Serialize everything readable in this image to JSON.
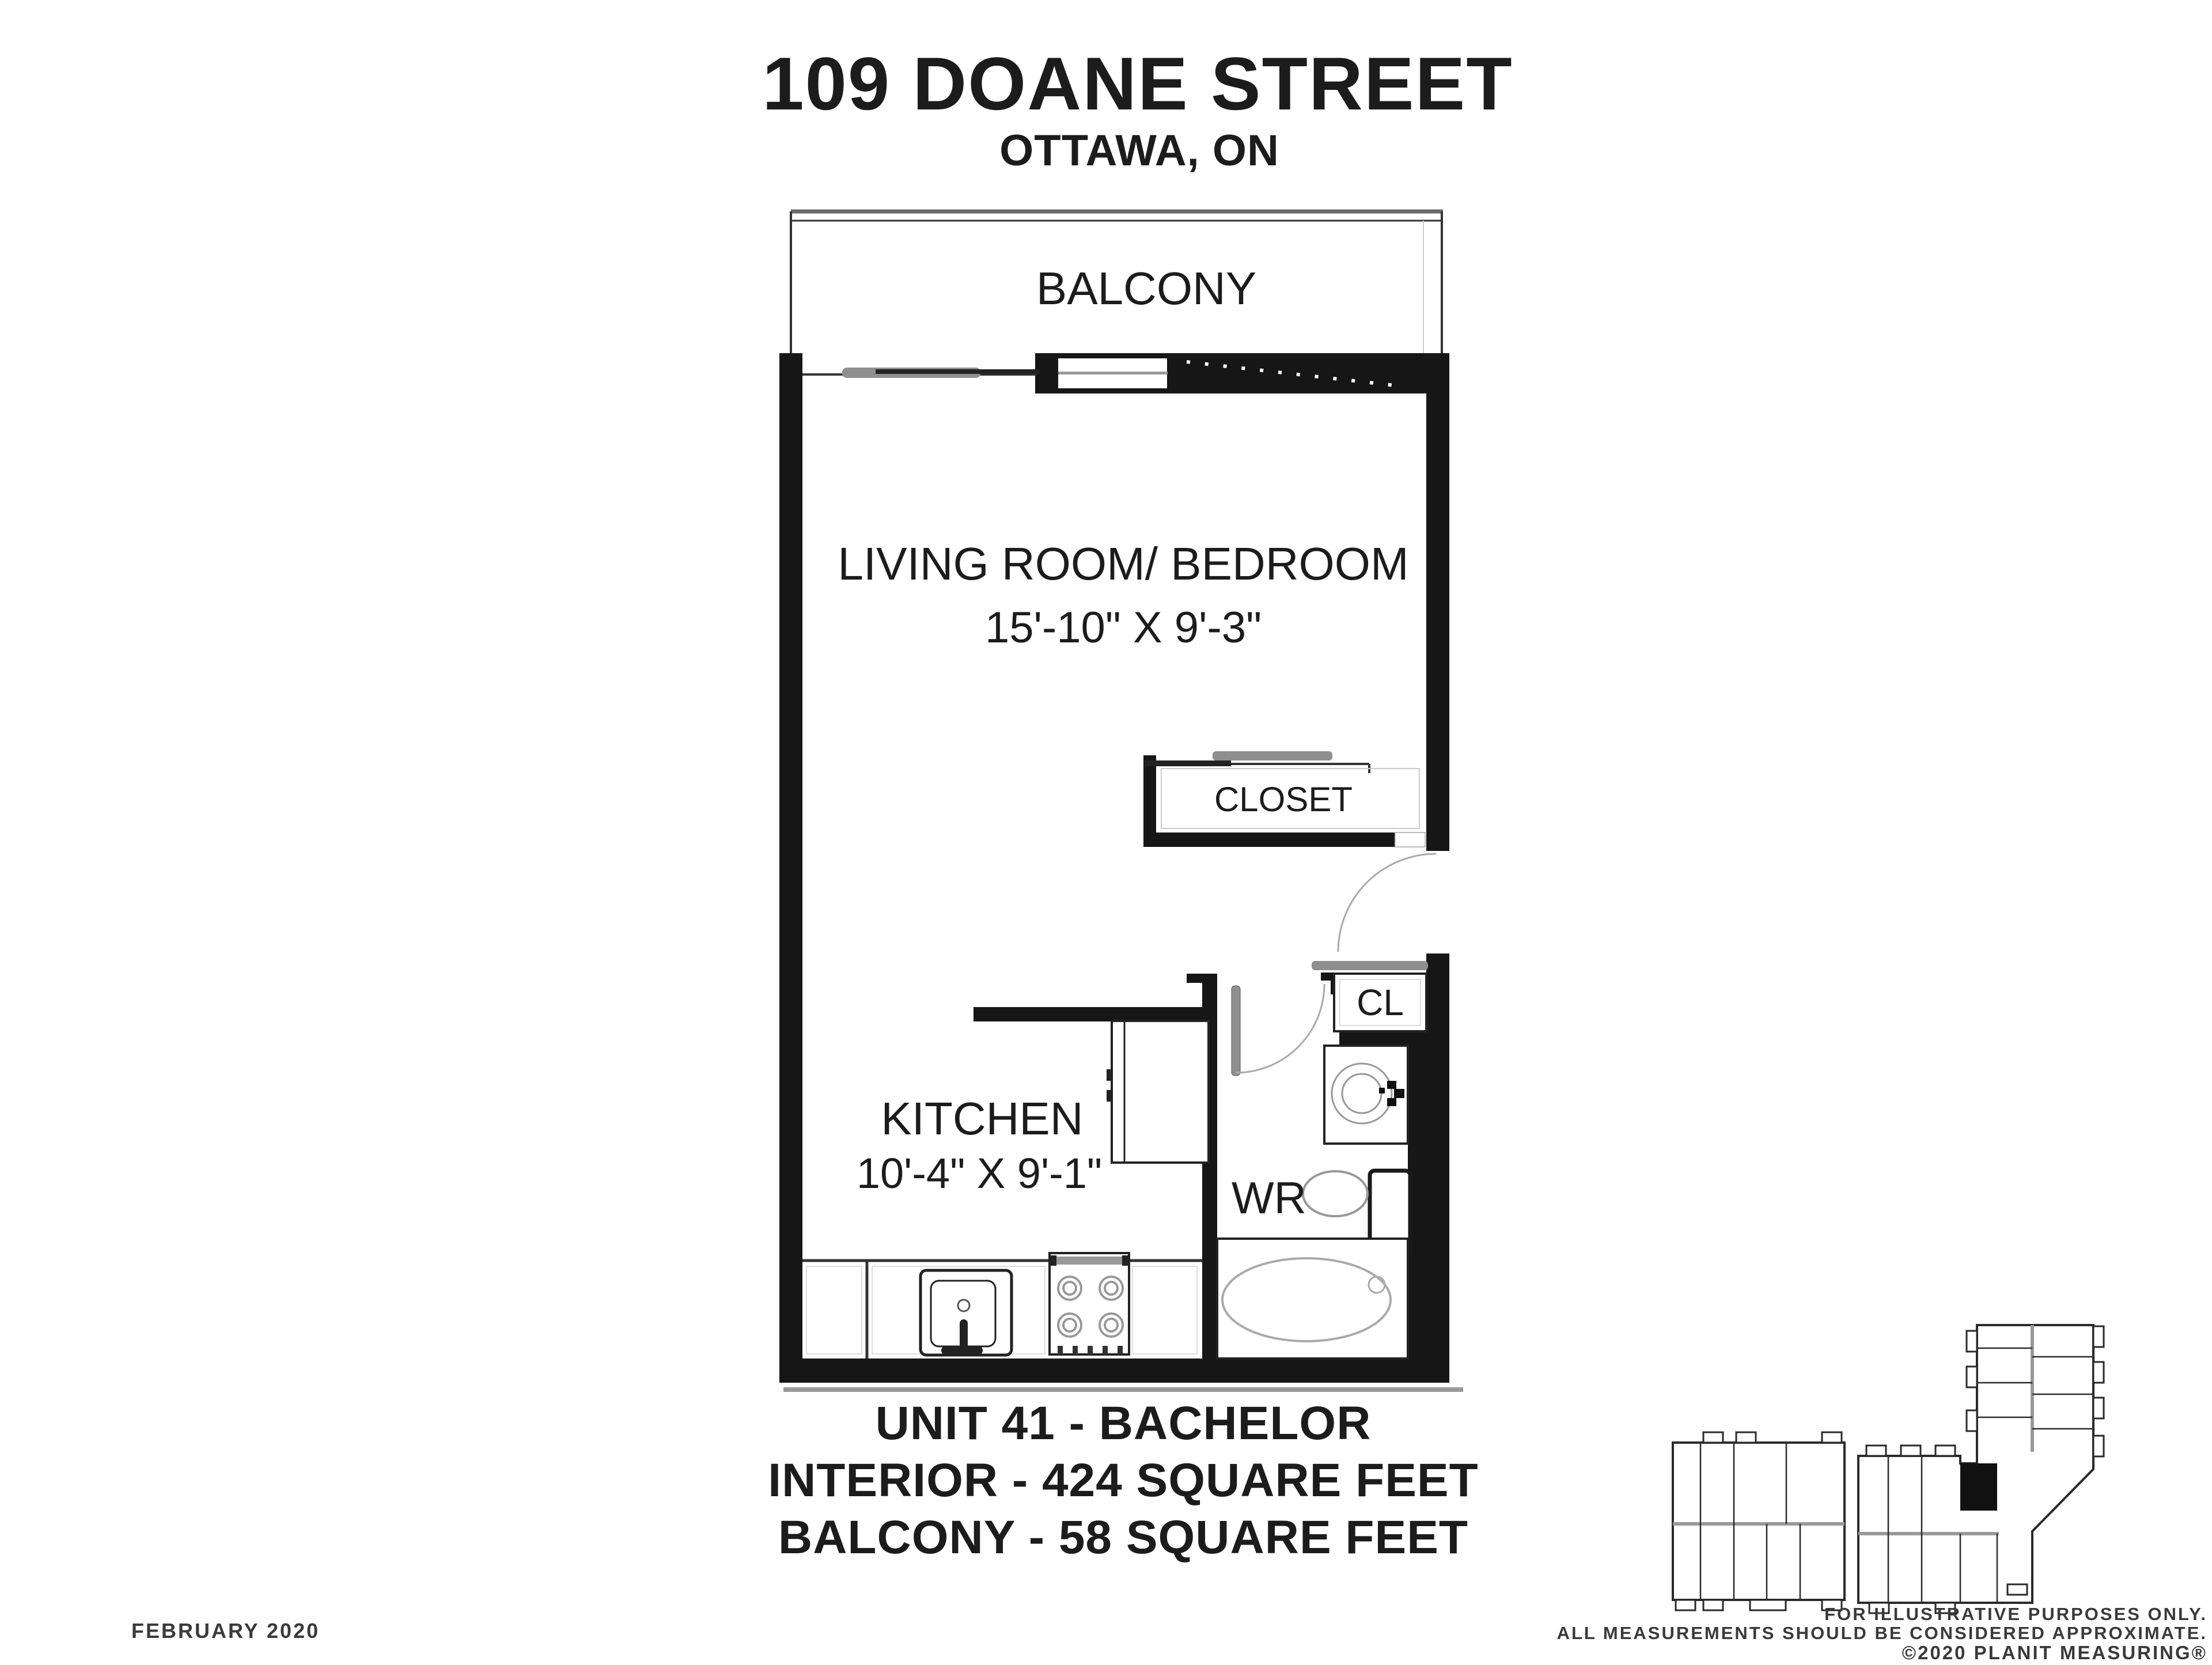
{
  "header": {
    "title": "109 DOANE STREET",
    "subtitle": "OTTAWA, ON"
  },
  "plan": {
    "balcony": "BALCONY",
    "living_room": {
      "label": "LIVING ROOM/ BEDROOM",
      "dims": "15'-10\" X 9'-3\""
    },
    "closet": "CLOSET",
    "kitchen": {
      "label": "KITCHEN",
      "dims": "10'-4\" X 9'-1\""
    },
    "wr": "WR",
    "cl": "CL"
  },
  "summary": {
    "unit": "UNIT 41 - BACHELOR",
    "interior": "INTERIOR - 424 SQUARE FEET",
    "balcony": "BALCONY - 58 SQUARE FEET"
  },
  "footer": {
    "date": "FEBRUARY 2020",
    "line1": "FOR ILLUSTRATIVE PURPOSES ONLY.",
    "line2": "ALL MEASUREMENTS SHOULD BE CONSIDERED APPROXIMATE.",
    "line3": "©2020 PLANIT MEASURING®"
  },
  "colors": {
    "wall": "#161616",
    "thin_line": "#333333",
    "light_line": "#9a9a9a",
    "door_panel": "#8f8f8f",
    "text": "#1c1c1c",
    "background": "#ffffff"
  }
}
